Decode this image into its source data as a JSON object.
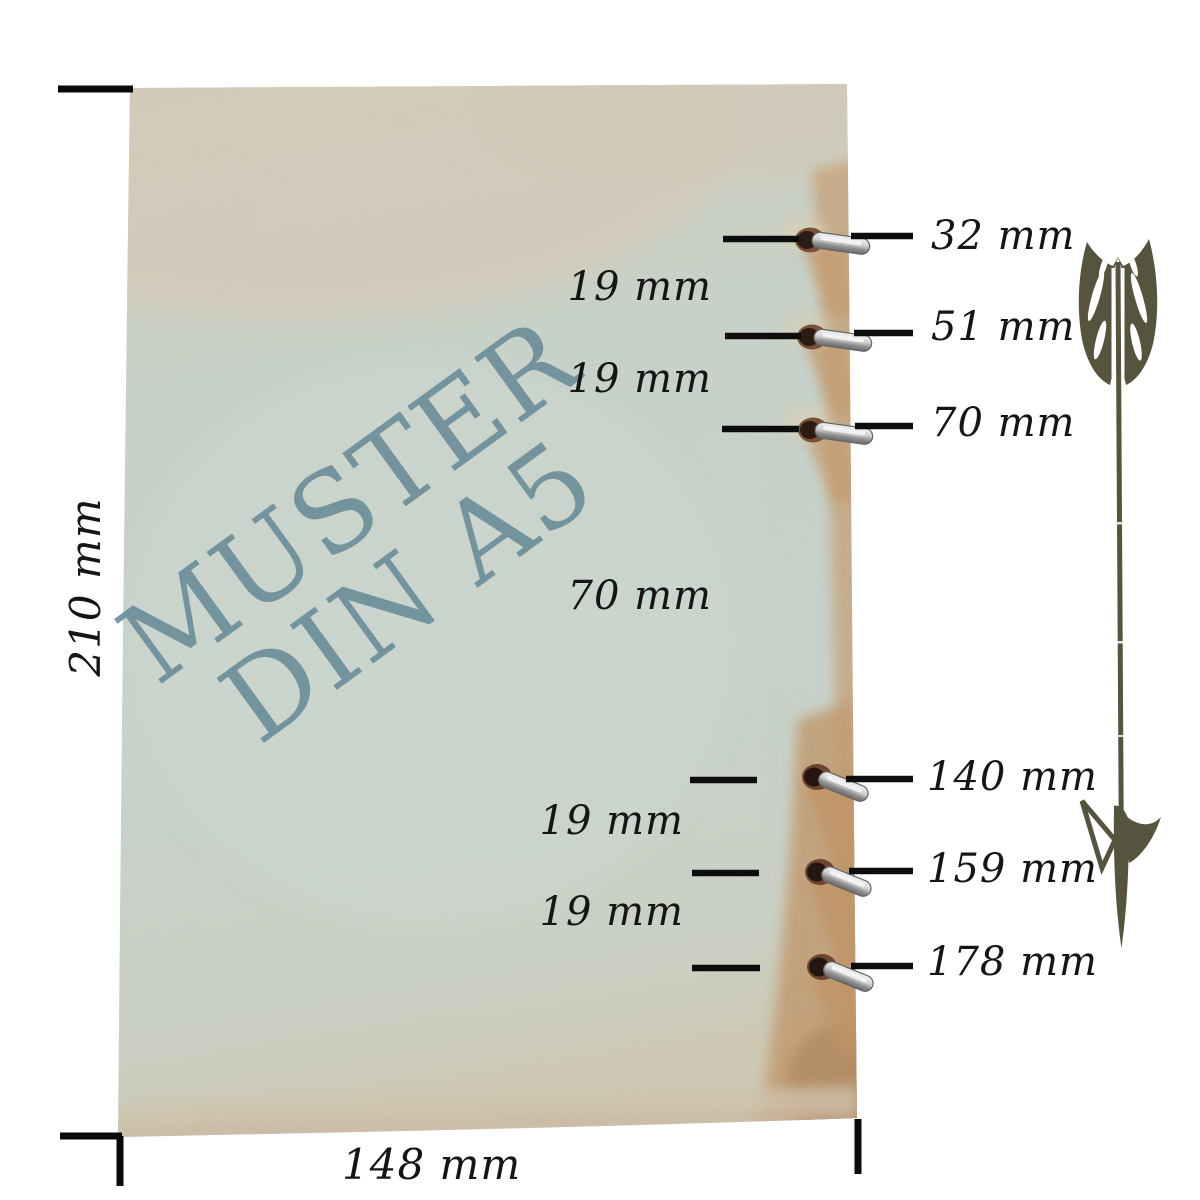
{
  "paper": {
    "watermark_line1": "MUSTER",
    "watermark_line2": "DIN A5",
    "height_label": "210 mm",
    "width_label": "148 mm"
  },
  "holes": [
    {
      "label": "32 mm"
    },
    {
      "label": "51 mm"
    },
    {
      "label": "70 mm"
    },
    {
      "label": "140 mm"
    },
    {
      "label": "159 mm"
    },
    {
      "label": "178 mm"
    }
  ],
  "spacings": [
    {
      "label": "19 mm"
    },
    {
      "label": "19 mm"
    },
    {
      "label": "70 mm"
    },
    {
      "label": "19 mm"
    },
    {
      "label": "19 mm"
    }
  ],
  "icons": {
    "arrow": "arrow-down-icon"
  },
  "colors": {
    "paper_top_beige": "#d5ccbc",
    "paper_body_green": "#c5d1ca",
    "stain_tan": "#c39a6e",
    "hole_rim_brown": "#7a5138",
    "hole_dark": "#2c1b12",
    "metal_ring": "#cfcfcf",
    "watermark_text": "#6b8d98",
    "arrow_olive": "#56543e",
    "dimension_line": "#0d0d0d",
    "label_text": "#151515"
  }
}
